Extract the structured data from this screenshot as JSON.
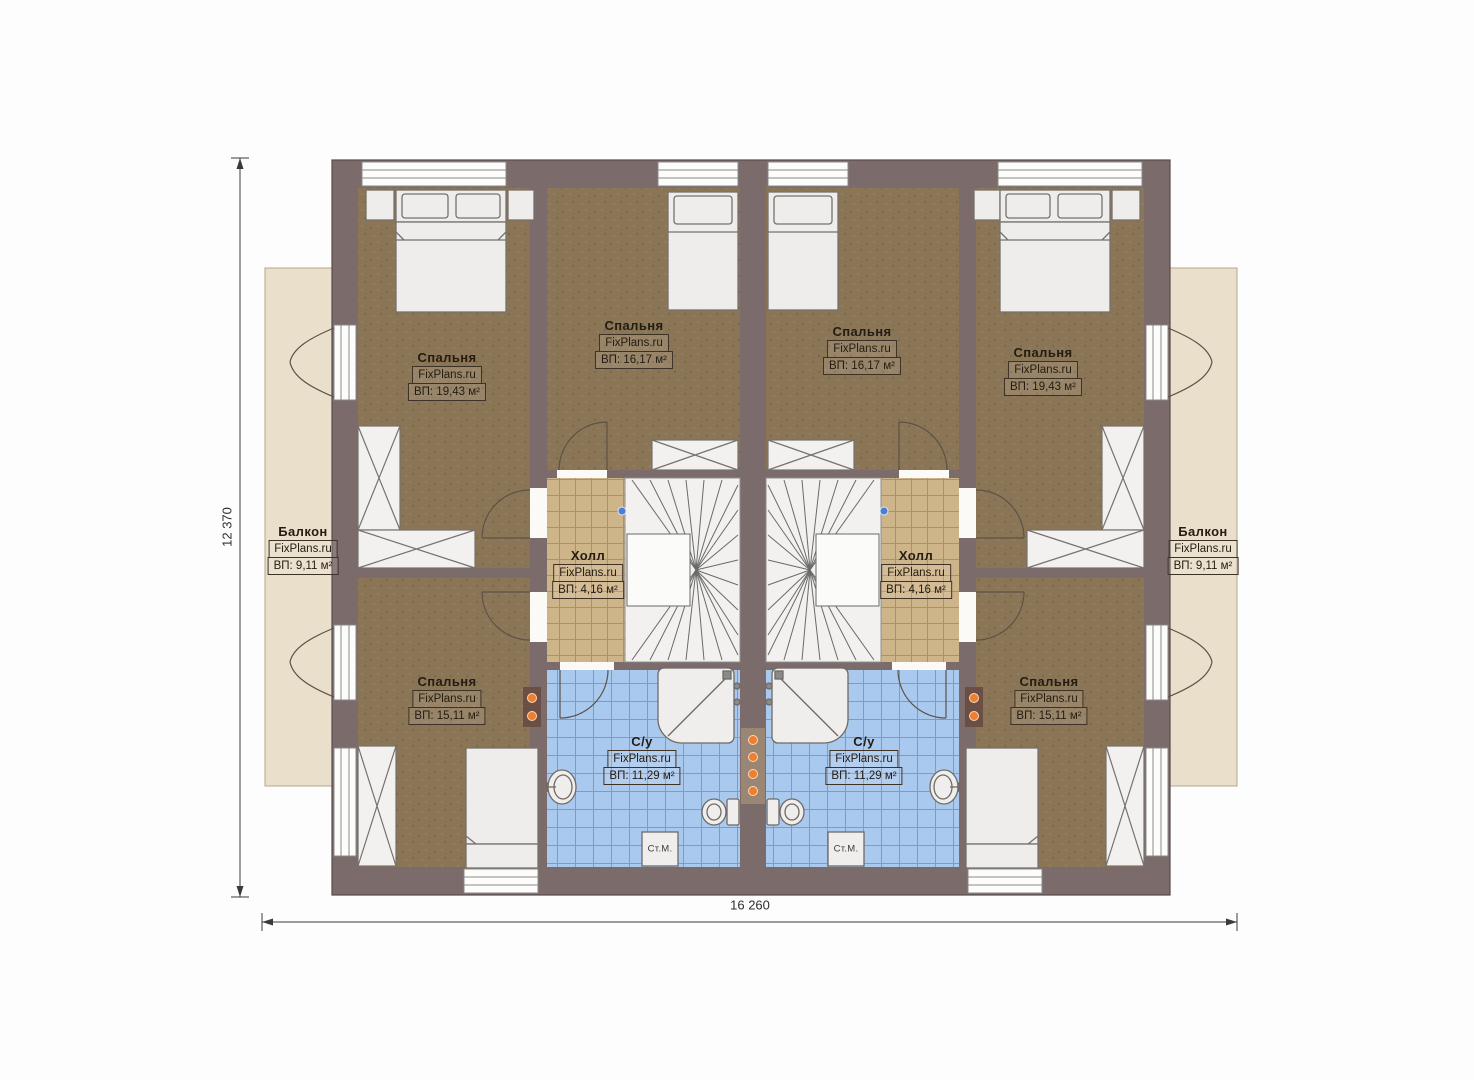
{
  "watermark": "FixPlans.ru",
  "dimensions": {
    "width_label": "16 260",
    "height_label": "12 370"
  },
  "appliances": {
    "washing_machine": "Ст.М."
  },
  "rooms": [
    {
      "id": "bedroom-top-left",
      "name": "Спальня",
      "area": "ВП: 19,43 м²"
    },
    {
      "id": "bedroom-mid-left",
      "name": "Спальня",
      "area": "ВП: 16,17 м²"
    },
    {
      "id": "bedroom-mid-right",
      "name": "Спальня",
      "area": "ВП: 16,17 м²"
    },
    {
      "id": "bedroom-top-right",
      "name": "Спальня",
      "area": "ВП: 19,43 м²"
    },
    {
      "id": "balcony-left",
      "name": "Балкон",
      "area": "ВП: 9,11 м²"
    },
    {
      "id": "balcony-right",
      "name": "Балкон",
      "area": "ВП: 9,11 м²"
    },
    {
      "id": "hall-left",
      "name": "Холл",
      "area": "ВП: 4,16 м²"
    },
    {
      "id": "hall-right",
      "name": "Холл",
      "area": "ВП: 4,16 м²"
    },
    {
      "id": "bedroom-bottom-left",
      "name": "Спальня",
      "area": "ВП: 15,11 м²"
    },
    {
      "id": "bedroom-bottom-right",
      "name": "Спальня",
      "area": "ВП: 15,11 м²"
    },
    {
      "id": "bathroom-left",
      "name": "С/у",
      "area": "ВП: 11,29 м²"
    },
    {
      "id": "bathroom-right",
      "name": "С/у",
      "area": "ВП: 11,29 м²"
    }
  ],
  "colors": {
    "wall": "#7b6b6b",
    "bedroom_floor": "#8a7656",
    "hall_floor": "#ceb489",
    "bath_floor": "#a9c9ee",
    "balcony_floor": "#e9dfca",
    "radiator_orange": "#ee7f2e",
    "marker_blue": "#4a7fd4"
  }
}
